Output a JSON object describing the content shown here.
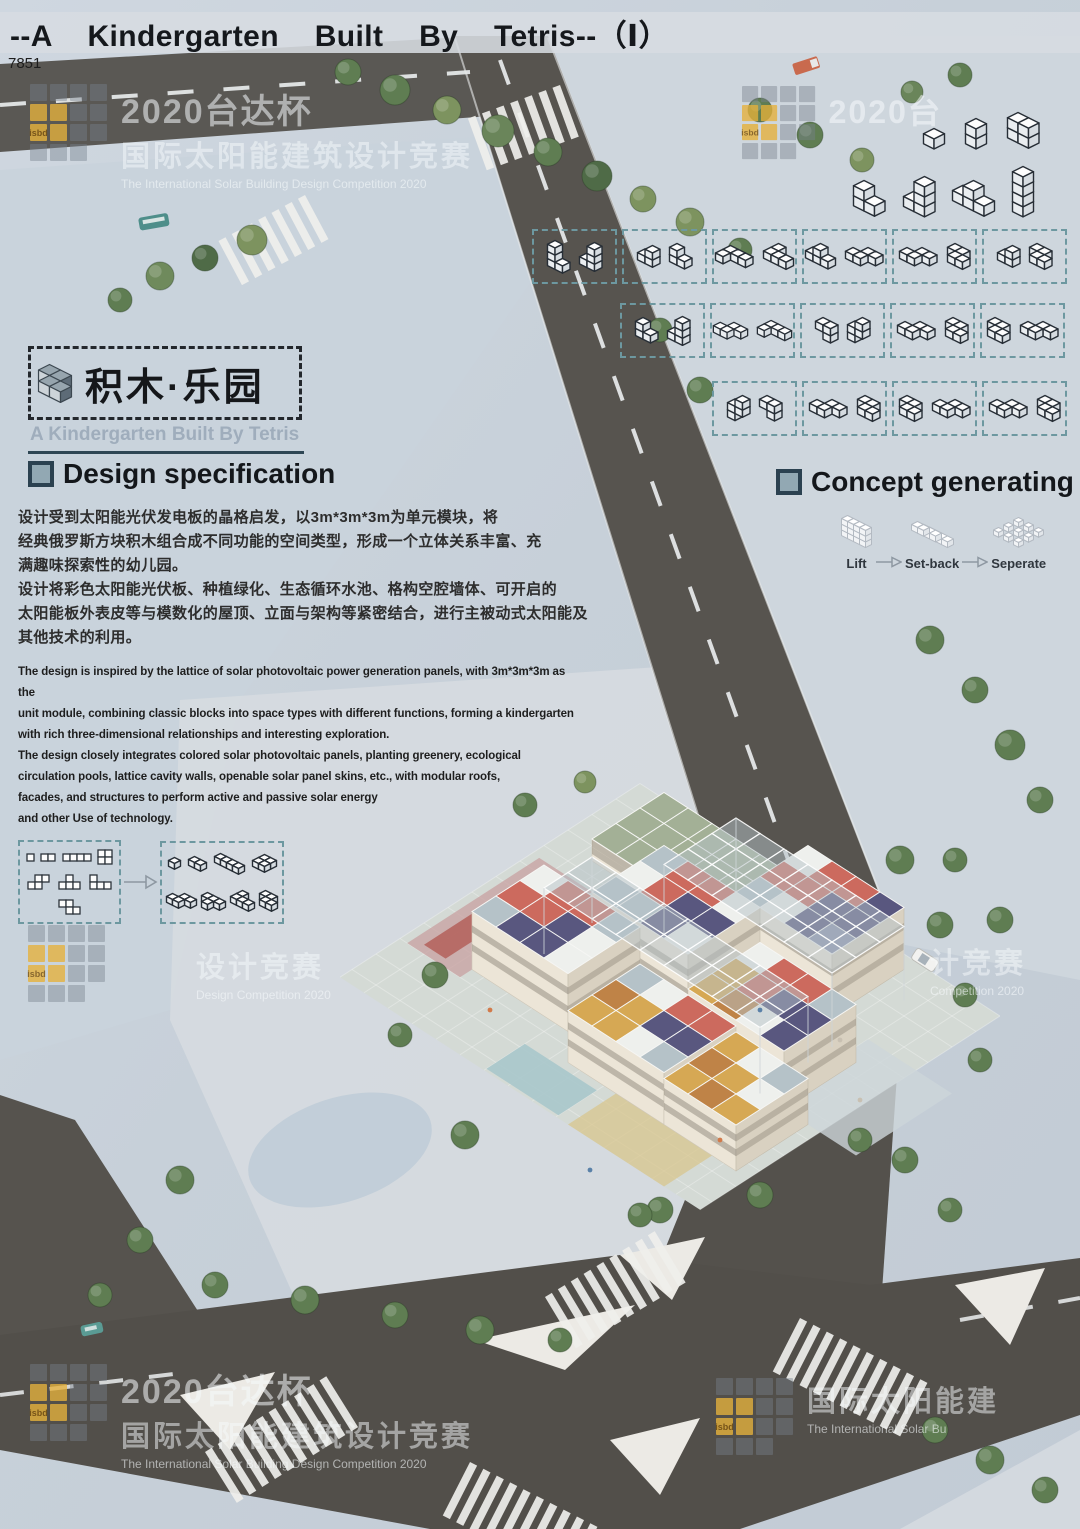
{
  "header": {
    "title": "--A Kindergarten Built By Tetris--（Ⅰ）",
    "plate": "7851"
  },
  "logo": {
    "cjk": "积木·乐园",
    "en": "A Kindergarten Built By Tetris"
  },
  "sections": {
    "design": {
      "heading": "Design specification",
      "cn": [
        "设计受到太阳能光伏发电板的晶格启发，以3m*3m*3m为单元模块，将",
        "经典俄罗斯方块积木组合成不同功能的空间类型，形成一个立体关系丰富、充",
        "满趣味探索性的幼儿园。",
        "设计将彩色太阳能光伏板、种植绿化、生态循环水池、格构空腔墙体、可开启的",
        "太阳能板外表皮等与模数化的屋顶、立面与架构等紧密结合，进行主被动式太阳能及",
        "其他技术的利用。"
      ],
      "en": [
        "The design is inspired by the lattice of solar photovoltaic power generation panels, with 3m*3m*3m as the",
        "unit module, combining classic blocks into space types with different functions, forming a kindergarten",
        "with rich three-dimensional relationships and interesting exploration.",
        "The design closely integrates colored solar photovoltaic panels, planting greenery, ecological",
        "circulation pools, lattice cavity walls, openable solar panel skins, etc., with modular roofs,",
        "facades, and structures to perform active and passive solar energy",
        "and other Use of technology."
      ]
    },
    "concept": {
      "heading": "Concept generating",
      "steps": [
        {
          "label": "Lift",
          "piece": "lift",
          "s": 6
        },
        {
          "label": "Set-back",
          "piece": "setback",
          "s": 6
        },
        {
          "label": "Seperate",
          "piece": "seperate",
          "s": 5
        }
      ]
    }
  },
  "pieces": {
    "c1": [
      [
        0,
        0,
        0
      ]
    ],
    "d2": [
      [
        0,
        0,
        0
      ],
      [
        1,
        0,
        0
      ]
    ],
    "i3": [
      [
        0,
        0,
        0
      ],
      [
        1,
        0,
        0
      ],
      [
        2,
        0,
        0
      ]
    ],
    "i4": [
      [
        0,
        0,
        0
      ],
      [
        1,
        0,
        0
      ],
      [
        2,
        0,
        0
      ],
      [
        3,
        0,
        0
      ]
    ],
    "v2": [
      [
        0,
        0,
        0
      ],
      [
        0,
        0,
        1
      ]
    ],
    "w22": [
      [
        0,
        0,
        0
      ],
      [
        1,
        0,
        0
      ],
      [
        0,
        0,
        1
      ],
      [
        1,
        0,
        1
      ]
    ],
    "col4": [
      [
        0,
        0,
        0
      ],
      [
        0,
        0,
        1
      ],
      [
        0,
        0,
        2
      ],
      [
        0,
        0,
        3
      ]
    ],
    "lv3a": [
      [
        0,
        0,
        0
      ],
      [
        1,
        0,
        0
      ],
      [
        0,
        0,
        1
      ]
    ],
    "lv3b": [
      [
        0,
        0,
        0
      ],
      [
        1,
        0,
        0
      ],
      [
        1,
        0,
        1
      ]
    ],
    "lv4a": [
      [
        0,
        0,
        0
      ],
      [
        0,
        0,
        1
      ],
      [
        0,
        0,
        2
      ],
      [
        1,
        0,
        0
      ]
    ],
    "lv4b": [
      [
        0,
        0,
        0
      ],
      [
        1,
        0,
        0
      ],
      [
        1,
        0,
        1
      ],
      [
        1,
        0,
        2
      ]
    ],
    "t3d": [
      [
        0,
        0,
        0
      ],
      [
        1,
        0,
        0
      ],
      [
        2,
        0,
        0
      ],
      [
        1,
        0,
        1
      ]
    ],
    "sv4": [
      [
        0,
        0,
        0
      ],
      [
        0,
        0,
        1
      ],
      [
        1,
        0,
        1
      ],
      [
        1,
        0,
        2
      ]
    ],
    "zv3": [
      [
        0,
        0,
        1
      ],
      [
        1,
        0,
        1
      ],
      [
        1,
        0,
        0
      ]
    ],
    "sq4": [
      [
        0,
        0,
        0
      ],
      [
        1,
        0,
        0
      ],
      [
        0,
        1,
        0
      ],
      [
        1,
        1,
        0
      ]
    ],
    "sf4": [
      [
        1,
        0,
        0
      ],
      [
        2,
        0,
        0
      ],
      [
        0,
        1,
        0
      ],
      [
        1,
        1,
        0
      ]
    ],
    "zf4": [
      [
        0,
        0,
        0
      ],
      [
        1,
        0,
        0
      ],
      [
        1,
        1,
        0
      ],
      [
        2,
        1,
        0
      ]
    ],
    "tf4": [
      [
        0,
        0,
        0
      ],
      [
        1,
        0,
        0
      ],
      [
        2,
        0,
        0
      ],
      [
        1,
        1,
        0
      ]
    ],
    "lf4": [
      [
        0,
        0,
        0
      ],
      [
        0,
        1,
        0
      ],
      [
        1,
        1,
        0
      ],
      [
        2,
        1,
        0
      ]
    ],
    "jf4": [
      [
        0,
        0,
        0
      ],
      [
        1,
        0,
        0
      ],
      [
        2,
        0,
        0
      ],
      [
        0,
        1,
        0
      ]
    ],
    "logo": [
      [
        0,
        0,
        0
      ],
      [
        1,
        0,
        0
      ],
      [
        1,
        1,
        0
      ],
      [
        2,
        1,
        0
      ]
    ],
    "lift": [
      [
        0,
        0,
        0
      ],
      [
        1,
        0,
        0
      ],
      [
        2,
        0,
        0
      ],
      [
        3,
        0,
        0
      ],
      [
        0,
        0,
        1
      ],
      [
        1,
        0,
        1
      ],
      [
        2,
        0,
        1
      ],
      [
        3,
        0,
        1
      ],
      [
        0,
        0,
        2
      ],
      [
        1,
        0,
        2
      ],
      [
        2,
        0,
        2
      ],
      [
        3,
        0,
        2
      ]
    ],
    "setback": [
      [
        0,
        0,
        0
      ],
      [
        1,
        0,
        0
      ],
      [
        2,
        0,
        0
      ],
      [
        3,
        0,
        0
      ],
      [
        0,
        1,
        1
      ],
      [
        1,
        1,
        1
      ],
      [
        2,
        1,
        1
      ],
      [
        0,
        2,
        2
      ],
      [
        1,
        2,
        2
      ]
    ],
    "seperate": [
      [
        0,
        0,
        0
      ],
      [
        2,
        0,
        0
      ],
      [
        4,
        0,
        0
      ],
      [
        0,
        2,
        0
      ],
      [
        2,
        2,
        0
      ],
      [
        4,
        2,
        0
      ],
      [
        0,
        4,
        0
      ],
      [
        2,
        4,
        0
      ],
      [
        4,
        4,
        0
      ]
    ]
  },
  "concept_rows": {
    "solid": [
      [
        "c1",
        "v2",
        "w22"
      ],
      [
        "lv3a",
        "lv4b",
        "t3d",
        "col4"
      ]
    ],
    "boxed": [
      [
        [
          "lv4a",
          "lv4b"
        ],
        [
          "lv3b",
          "lv3a"
        ],
        [
          "jf4",
          "lf4"
        ],
        [
          "t3d",
          "sf4"
        ],
        [
          "sf4",
          "zf4"
        ],
        [
          "lv3b",
          "zf4"
        ]
      ],
      [
        [
          "lv3a",
          "lv4b"
        ],
        [
          "sf4",
          "jf4"
        ],
        [
          "zv3",
          "sv4"
        ],
        [
          "sf4",
          "zf4"
        ],
        [
          "zf4",
          "sf4"
        ]
      ],
      [
        [
          "sv4",
          "zv3"
        ],
        [
          "sf4",
          "zf4"
        ],
        [
          "zf4",
          "sf4"
        ],
        [
          "sf4",
          "zf4"
        ]
      ]
    ]
  },
  "concept_left": {
    "flat": [
      [
        [
          0,
          0
        ]
      ],
      [
        [
          0,
          0
        ],
        [
          1,
          0
        ]
      ],
      [
        [
          0,
          0
        ],
        [
          1,
          0
        ],
        [
          2,
          0
        ],
        [
          3,
          0
        ]
      ],
      [
        [
          0,
          0
        ],
        [
          1,
          0
        ],
        [
          0,
          1
        ],
        [
          1,
          1
        ]
      ],
      [
        [
          1,
          0
        ],
        [
          2,
          0
        ],
        [
          0,
          1
        ],
        [
          1,
          1
        ]
      ],
      [
        [
          1,
          0
        ],
        [
          0,
          1
        ],
        [
          1,
          1
        ],
        [
          2,
          1
        ]
      ],
      [
        [
          0,
          0
        ],
        [
          0,
          1
        ],
        [
          1,
          1
        ],
        [
          2,
          1
        ]
      ],
      [
        [
          0,
          0
        ],
        [
          1,
          0
        ],
        [
          1,
          1
        ],
        [
          2,
          1
        ]
      ]
    ],
    "iso": [
      "c1",
      "d2",
      "i4",
      "sq4",
      "sf4",
      "tf4",
      "lf4",
      "zf4"
    ]
  },
  "watermark": {
    "logo_text": "isbd",
    "pattern": [
      "gggg",
      "yygg",
      "iygg",
      "ggg."
    ],
    "items": [
      {
        "x": 30,
        "y": 84,
        "scale": 1,
        "logo": true,
        "lines": [
          [
            "l1",
            "2020台达杯"
          ],
          [
            "l2",
            "国际太阳能建筑设计竞赛"
          ],
          [
            "l3",
            "The International Solar Building Design Competition 2020"
          ]
        ]
      },
      {
        "x": 742,
        "y": 86,
        "scale": 0.95,
        "logo": true,
        "lines": [
          [
            "l1",
            "2020台"
          ]
        ]
      },
      {
        "x": 28,
        "y": 925,
        "scale": 1,
        "logo": true,
        "lines": []
      },
      {
        "x": 196,
        "y": 944,
        "scale": 1,
        "logo": false,
        "lines": [
          [
            "l2",
            "设计竞赛"
          ],
          [
            "l3",
            "Design Competition 2020"
          ]
        ]
      },
      {
        "x": 930,
        "y": 940,
        "scale": 1,
        "logo": false,
        "lines": [
          [
            "l2",
            "计竞赛"
          ],
          [
            "l3",
            "Competition 2020"
          ]
        ]
      },
      {
        "x": 30,
        "y": 1364,
        "scale": 1,
        "logo": true,
        "lines": [
          [
            "l1",
            "2020台达杯"
          ],
          [
            "l2",
            "国际太阳能建筑设计竞赛"
          ],
          [
            "l3",
            "The International Solar Building Design Competition 2020"
          ]
        ]
      },
      {
        "x": 716,
        "y": 1378,
        "scale": 1,
        "logo": true,
        "lines": [
          [
            "l2",
            "国际太阳能建"
          ],
          [
            "l3",
            "The International Solar Bu"
          ]
        ]
      }
    ]
  },
  "site": {
    "palette": {
      "W": "#eef0ed",
      "R": "#cc6a5e",
      "N": "#59577f",
      "S": "#b5c2c8",
      "G": "#a3b096",
      "Y": "#d6a854",
      "O": "#bf8347",
      "B": "#8b90ad"
    },
    "ground": {
      "gx": -1.5,
      "gy": -1.5,
      "w": 15,
      "d": 12.5,
      "color": "#d4dad5"
    },
    "patches": [
      {
        "gx": -1.2,
        "gy": 3.0,
        "w": 2.2,
        "d": 5.5,
        "c": "#c8a0a0",
        "o": 0.75
      },
      {
        "gx": -0.8,
        "gy": 3.4,
        "w": 0.9,
        "d": 4.8,
        "c": "#b25b55",
        "o": 0.8
      },
      {
        "gx": 4.5,
        "gy": 9.3,
        "w": 3.0,
        "d": 1.6,
        "c": "#a9c6cb",
        "o": 0.9
      },
      {
        "gx": 8.0,
        "gy": 9.0,
        "w": 4.0,
        "d": 2.0,
        "c": "#d8c68e",
        "o": 0.75
      },
      {
        "gx": 11.5,
        "gy": 2.0,
        "w": 3.5,
        "d": 4.0,
        "c": "#cdd6da",
        "o": 0.8
      }
    ],
    "modules": [
      {
        "type": "building",
        "gx": 0,
        "gy": -1,
        "w": 5,
        "d": 3,
        "h": 22,
        "roof": [
          [
            "G",
            "G",
            "G",
            "G",
            "G"
          ],
          [
            "G",
            "G",
            "G",
            "G",
            "G"
          ],
          [
            "G",
            "G",
            "G",
            "G",
            "G"
          ]
        ]
      },
      {
        "type": "building",
        "gx": 6,
        "gy": -1,
        "w": 4,
        "d": 3,
        "h": 62,
        "roof": [
          [
            "W",
            "R",
            "R",
            "N"
          ],
          [
            "R",
            "R",
            "N",
            "N"
          ],
          [
            "S",
            "W",
            "N",
            "B"
          ]
        ]
      },
      {
        "type": "building",
        "gx": 3,
        "gy": 2,
        "w": 4,
        "d": 3,
        "h": 62,
        "roof": [
          [
            "S",
            "R",
            "R",
            "W"
          ],
          [
            "W",
            "R",
            "N",
            "N"
          ],
          [
            "S",
            "S",
            "N",
            "W"
          ]
        ]
      },
      {
        "type": "building",
        "gx": 8,
        "gy": 3,
        "w": 4,
        "d": 3,
        "h": 58,
        "roof": [
          [
            "W",
            "R",
            "R",
            "S"
          ],
          [
            "Y",
            "R",
            "N",
            "N"
          ],
          [
            "Y",
            "O",
            "W",
            "N"
          ]
        ]
      },
      {
        "type": "building",
        "gx": 1,
        "gy": 5,
        "w": 4,
        "d": 3,
        "h": 58,
        "roof": [
          [
            "W",
            "R",
            "R",
            "S"
          ],
          [
            "R",
            "R",
            "N",
            "W"
          ],
          [
            "S",
            "N",
            "N",
            "W"
          ]
        ]
      },
      {
        "type": "building",
        "gx": 6,
        "gy": 6,
        "w": 4,
        "d": 3,
        "h": 52,
        "roof": [
          [
            "S",
            "W",
            "R",
            "R"
          ],
          [
            "O",
            "Y",
            "N",
            "N"
          ],
          [
            "Y",
            "Y",
            "W",
            "S"
          ]
        ]
      },
      {
        "type": "building",
        "gx": 10,
        "gy": 6,
        "w": 3,
        "d": 3,
        "h": 46,
        "roof": [
          [
            "Y",
            "W",
            "S"
          ],
          [
            "O",
            "Y",
            "W"
          ],
          [
            "Y",
            "O",
            "Y"
          ]
        ]
      },
      {
        "type": "canopy",
        "gx": 4,
        "gy": 0,
        "w": 7,
        "d": 3,
        "h": 74,
        "roof": "S"
      },
      {
        "type": "canopy",
        "gx": 2,
        "gy": 4,
        "w": 9,
        "d": 2,
        "h": 66,
        "roof": "S"
      }
    ],
    "trees": [
      [
        560,
        150,
        14
      ],
      [
        600,
        215,
        13
      ],
      [
        625,
        285,
        12
      ],
      [
        95,
        265,
        13
      ],
      [
        60,
        325,
        12
      ],
      [
        125,
        425,
        14
      ],
      [
        420,
        485,
        13
      ],
      [
        300,
        505,
        12
      ],
      [
        185,
        95,
        12
      ],
      [
        245,
        72,
        11
      ],
      [
        640,
        350,
        12
      ],
      [
        520,
        430,
        12
      ]
    ]
  },
  "scene": {
    "trees": [
      [
        348,
        72,
        13
      ],
      [
        395,
        90,
        15
      ],
      [
        447,
        110,
        14
      ],
      [
        498,
        131,
        16
      ],
      [
        548,
        152,
        14
      ],
      [
        597,
        176,
        15
      ],
      [
        643,
        199,
        13
      ],
      [
        690,
        222,
        14
      ],
      [
        740,
        250,
        12
      ],
      [
        252,
        240,
        15
      ],
      [
        205,
        258,
        13
      ],
      [
        160,
        276,
        14
      ],
      [
        120,
        300,
        12
      ],
      [
        760,
        110,
        12
      ],
      [
        810,
        135,
        13
      ],
      [
        862,
        160,
        12
      ],
      [
        912,
        92,
        11
      ],
      [
        960,
        75,
        12
      ],
      [
        660,
        330,
        12
      ],
      [
        700,
        390,
        13
      ],
      [
        930,
        640,
        14
      ],
      [
        975,
        690,
        13
      ],
      [
        1010,
        745,
        15
      ],
      [
        1040,
        800,
        13
      ],
      [
        955,
        860,
        12
      ],
      [
        1000,
        920,
        13
      ],
      [
        180,
        1180,
        14
      ],
      [
        140,
        1240,
        13
      ],
      [
        100,
        1295,
        12
      ],
      [
        215,
        1285,
        13
      ],
      [
        305,
        1300,
        14
      ],
      [
        395,
        1315,
        13
      ],
      [
        480,
        1330,
        14
      ],
      [
        560,
        1340,
        12
      ],
      [
        660,
        1210,
        13
      ],
      [
        905,
        1160,
        13
      ],
      [
        950,
        1210,
        12
      ],
      [
        935,
        1430,
        13
      ],
      [
        990,
        1460,
        14
      ],
      [
        1045,
        1490,
        13
      ]
    ]
  }
}
